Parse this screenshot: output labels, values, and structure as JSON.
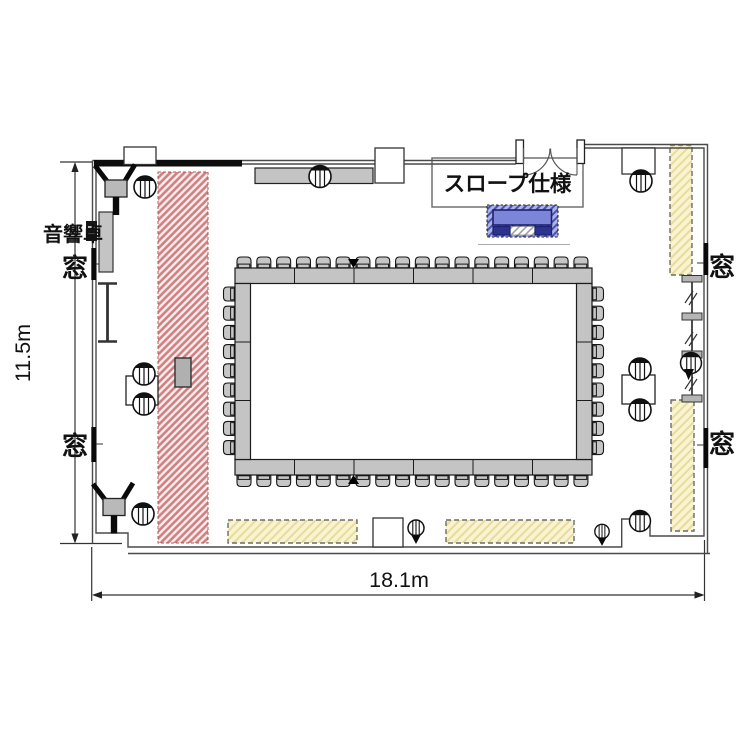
{
  "labels": {
    "audio_console": "音響卓",
    "window": "窓",
    "slope_spec": "スロープ仕様",
    "height_dim": "11.5m",
    "width_dim": "18.1m"
  },
  "furniture": {
    "conference_chairs": {
      "top": 18,
      "bottom": 18,
      "left": 9,
      "right": 9
    },
    "conference_table_segments": {
      "top": 6,
      "bottom": 6,
      "left": 3,
      "right": 3
    },
    "side_tables_with_two_chairs": 2,
    "speakers": 2,
    "mic_stands": 3
  },
  "colors": {
    "wall": "#4a4a4a",
    "thick_wall": "#0d0d0d",
    "table_gray": "#c4c4c4",
    "red_zone_stripe": "#cf7f7f",
    "red_zone_border": "#b05858",
    "yellow_zone_fill": "#f9f4cf",
    "yellow_zone_stripe": "#e6dc9e",
    "blue_table_hatch": "#4950b8",
    "blue_table_solid": "#7c85d8",
    "blue_table_dark": "#2c338f",
    "text": "#111111"
  }
}
